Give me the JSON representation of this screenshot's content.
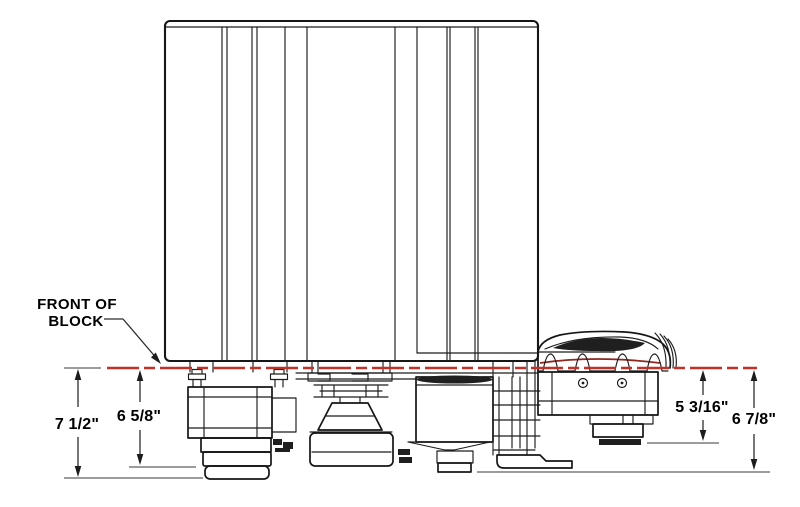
{
  "figure": {
    "type": "technical-dimension-drawing",
    "label_front_of_block": {
      "line1": "FRONT OF",
      "line2": "BLOCK"
    },
    "dimensions": {
      "overall_left": "7 1/2\"",
      "inner_left": "6 5/8\"",
      "inner_right": "5 3/16\"",
      "overall_right": "6 7/8\""
    },
    "colors": {
      "datum_line": "#c0312a",
      "datum_line_shadowed": "#8f2721",
      "drawing_line": "#161616",
      "shade": "#1f1f1f"
    }
  }
}
